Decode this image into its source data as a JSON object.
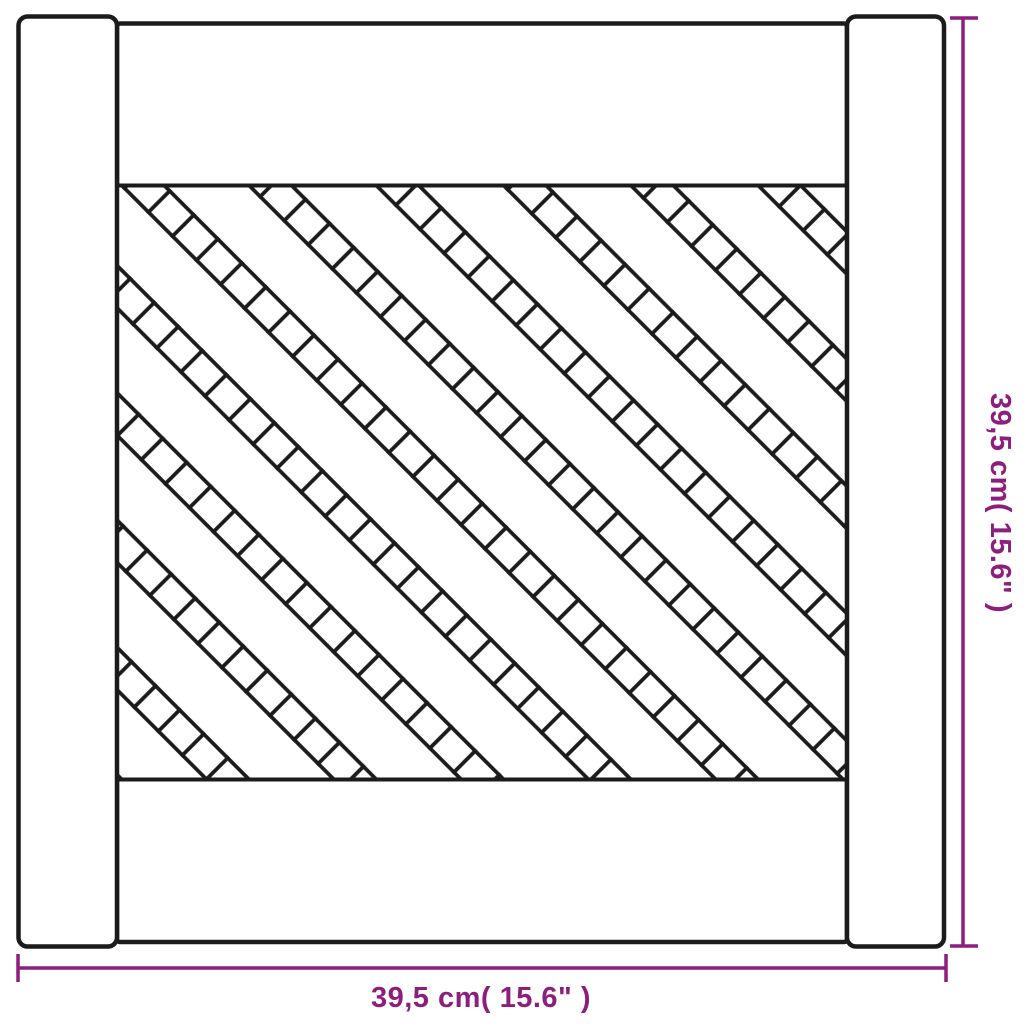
{
  "diagram": {
    "kind": "product-dimension-drawing",
    "subject": "cabinet door with diagonal lattice (trellis) panel",
    "panel_pattern": "diagonal-lattice-trellis"
  },
  "dimensions": {
    "height": {
      "label": "39,5 cm( 15.6\" )",
      "value_cm": "39,5",
      "value_inch": "15.6"
    },
    "width": {
      "label": "39,5 cm( 15.6\" )",
      "value_cm": "39,5",
      "value_inch": "15.6"
    }
  },
  "colors": {
    "outline": "#1b1b1b",
    "dimension_accent": "#8e1e7e",
    "background": "#ffffff"
  }
}
